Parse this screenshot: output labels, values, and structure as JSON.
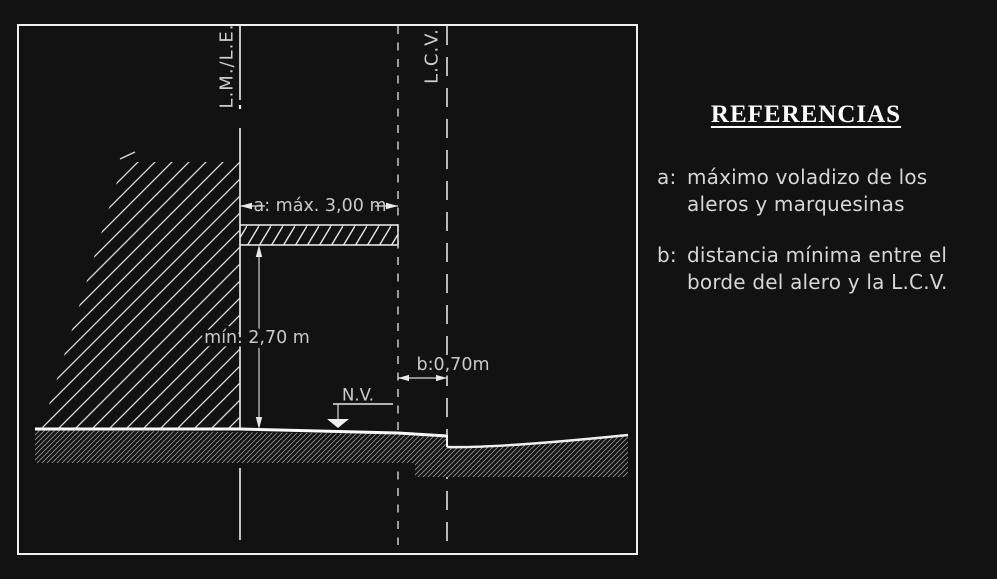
{
  "diagram": {
    "title": "street section regulation diagram",
    "labels": {
      "lm_le": "L.M./L.E.",
      "lcv": "L.C.V.",
      "dim_a": "a: máx. 3,00 m",
      "dim_min_height": "mín. 2,70 m",
      "dim_b": "b:0,70m",
      "nv": "N.V."
    }
  },
  "references": {
    "title": "REFERENCIAS",
    "items": [
      {
        "key": "a:",
        "text": "máximo voladizo de los\naleros y marquesinas"
      },
      {
        "key": "b:",
        "text": "distancia mínima entre el\nborde del alero y la L.C.V."
      }
    ]
  },
  "colors": {
    "background": "#121213",
    "line_white": "#f0f0f0",
    "dim_gray": "#c9c9c9",
    "fine_hatch_gray": "#8f8f8f"
  }
}
